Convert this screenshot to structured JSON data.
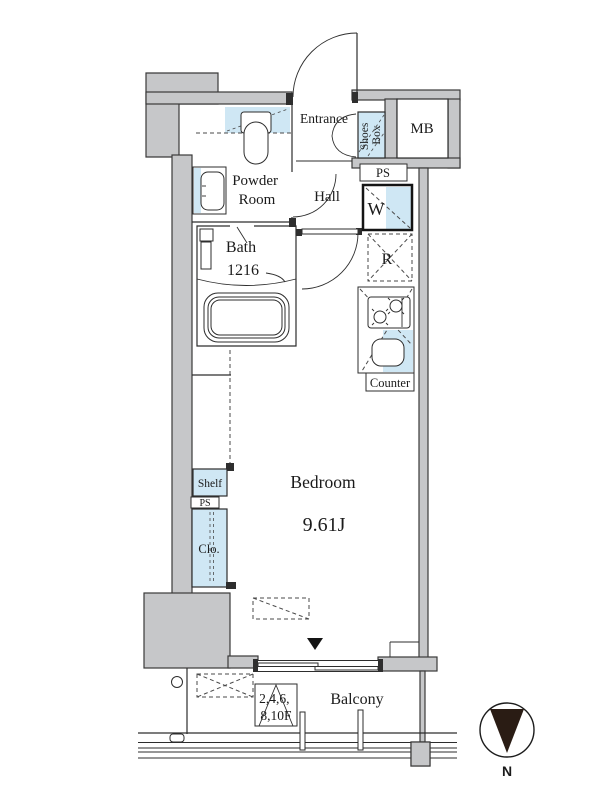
{
  "plan": {
    "type": "apartment-floor-plan",
    "colors": {
      "wall_gray": "#c6c7c9",
      "line_dark": "#2d2d2d",
      "fixture_blue": "#cfe7f4",
      "north_triangle": "#2a1c14",
      "background": "#ffffff"
    },
    "rooms": {
      "entrance": {
        "label": "Entrance"
      },
      "shoes_box": {
        "line1": "Shoes",
        "line2": "Box"
      },
      "meter_box": {
        "label": "MB"
      },
      "pipe_space_top": {
        "label": "PS"
      },
      "powder_room": {
        "line1": "Powder",
        "line2": "Room"
      },
      "hall": {
        "label": "Hall"
      },
      "washer": {
        "label": "W"
      },
      "bath": {
        "line1": "Bath",
        "line2": "1216"
      },
      "refrigerator": {
        "label": "R"
      },
      "counter": {
        "label": "Counter"
      },
      "bedroom": {
        "name": "Bedroom",
        "size": "9.61J"
      },
      "shelf": {
        "label": "Shelf"
      },
      "pipe_space_left": {
        "label": "PS"
      },
      "closet": {
        "label": "Clo."
      },
      "balcony": {
        "label": "Balcony"
      }
    },
    "annotations": {
      "floors_line1": "2,4,6,",
      "floors_line2": "8,10F",
      "compass_north": "N"
    }
  }
}
